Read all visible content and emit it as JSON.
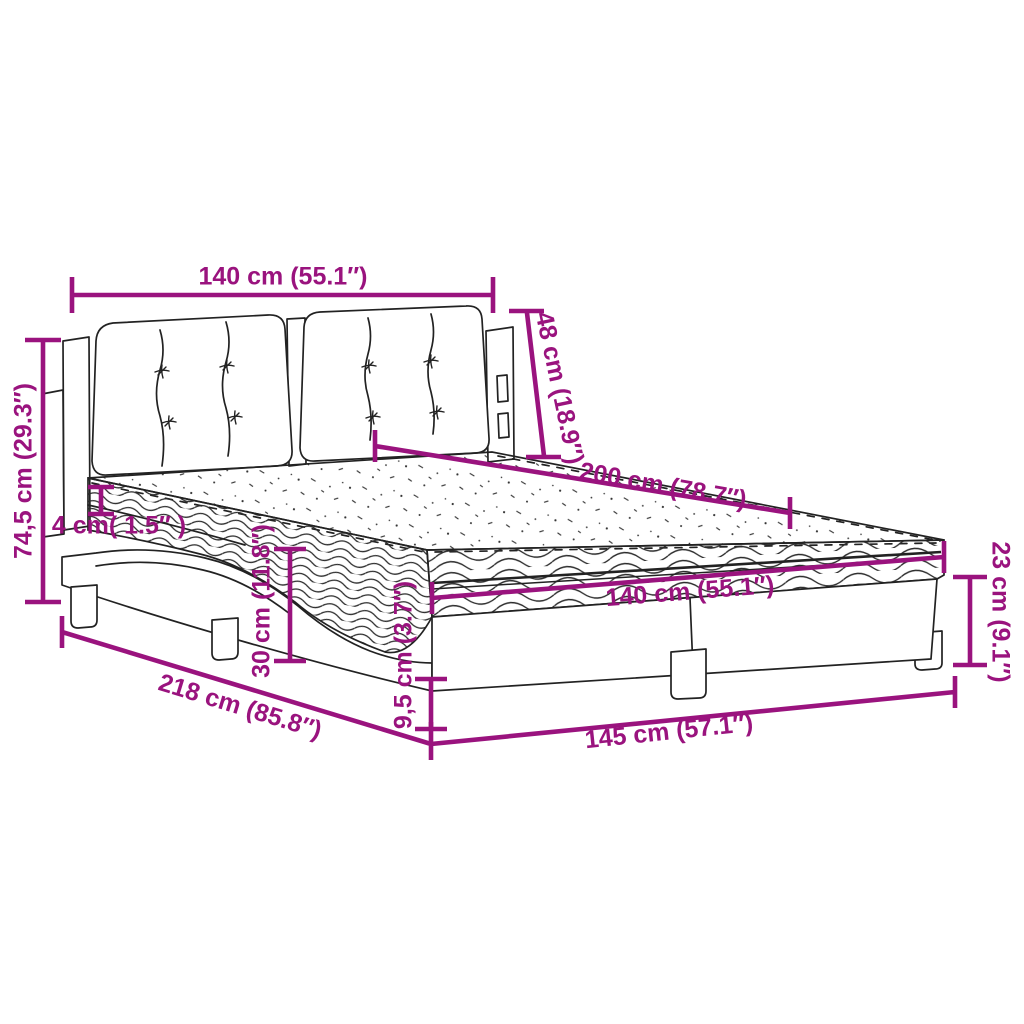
{
  "colors": {
    "dimension_annotation": "#9a137e",
    "line_art": "#222222",
    "background": "#ffffff"
  },
  "dimensions": {
    "headboard_width_top": "140 cm (55.1″)",
    "headboard_cushion_height": "48 cm (18.9″)",
    "total_height_left": "74,5 cm (29.3″)",
    "mattress_topper_thickness": "4 cm( 1.5″ )",
    "bed_length_top": "200 cm (78.7″)",
    "mattress_width_front": "140 cm (55.1″)",
    "frame_corner_height": "23 cm (9.1″)",
    "under_bed_clearance": "30 cm (11.8″)",
    "base_rail_height": "9,5 cm (3.7″)",
    "overall_length_diagonal": "218 cm (85.8″)",
    "base_width_bottom": "145 cm (57.1″)"
  }
}
